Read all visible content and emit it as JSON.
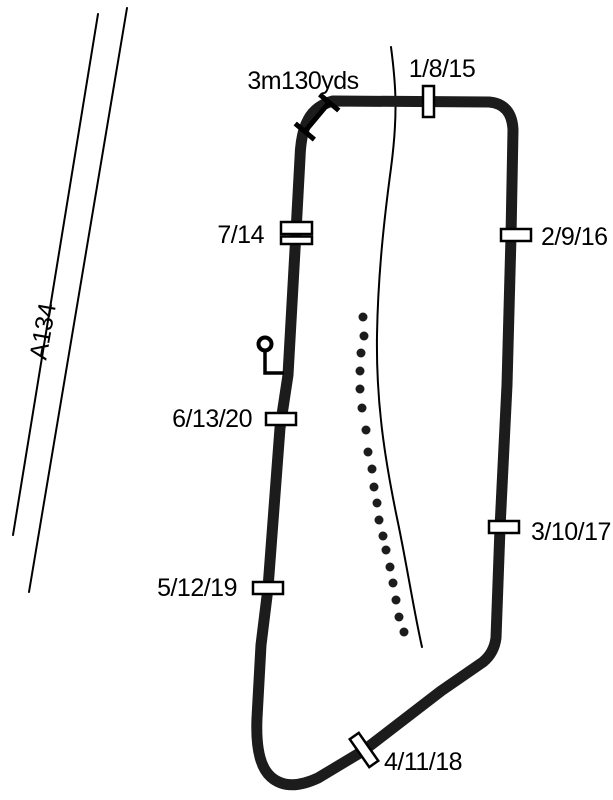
{
  "road": {
    "label": "A134"
  },
  "start": {
    "distance_label": "3m130yds"
  },
  "checkpoints": [
    {
      "label": "1/8/15"
    },
    {
      "label": "2/9/16"
    },
    {
      "label": "3/10/17"
    },
    {
      "label": "4/11/18"
    },
    {
      "label": "5/12/19"
    },
    {
      "label": "6/13/20"
    },
    {
      "label": "7/14"
    }
  ],
  "dotted_path": {
    "dot_radius": 4.5,
    "points": [
      [
        363,
        317
      ],
      [
        364,
        336
      ],
      [
        361,
        353
      ],
      [
        360,
        371
      ],
      [
        360,
        389
      ],
      [
        362,
        408
      ],
      [
        366,
        430
      ],
      [
        368,
        452
      ],
      [
        372,
        469
      ],
      [
        374,
        487
      ],
      [
        377,
        503
      ],
      [
        379,
        520
      ],
      [
        383,
        536
      ],
      [
        386,
        550
      ],
      [
        390,
        567
      ],
      [
        393,
        583
      ],
      [
        396,
        600
      ],
      [
        399,
        617
      ],
      [
        404,
        632
      ]
    ]
  },
  "colors": {
    "background": "#ffffff",
    "track": "#1c1c1c",
    "marker_fill": "#ffffff",
    "text": "#000000"
  }
}
